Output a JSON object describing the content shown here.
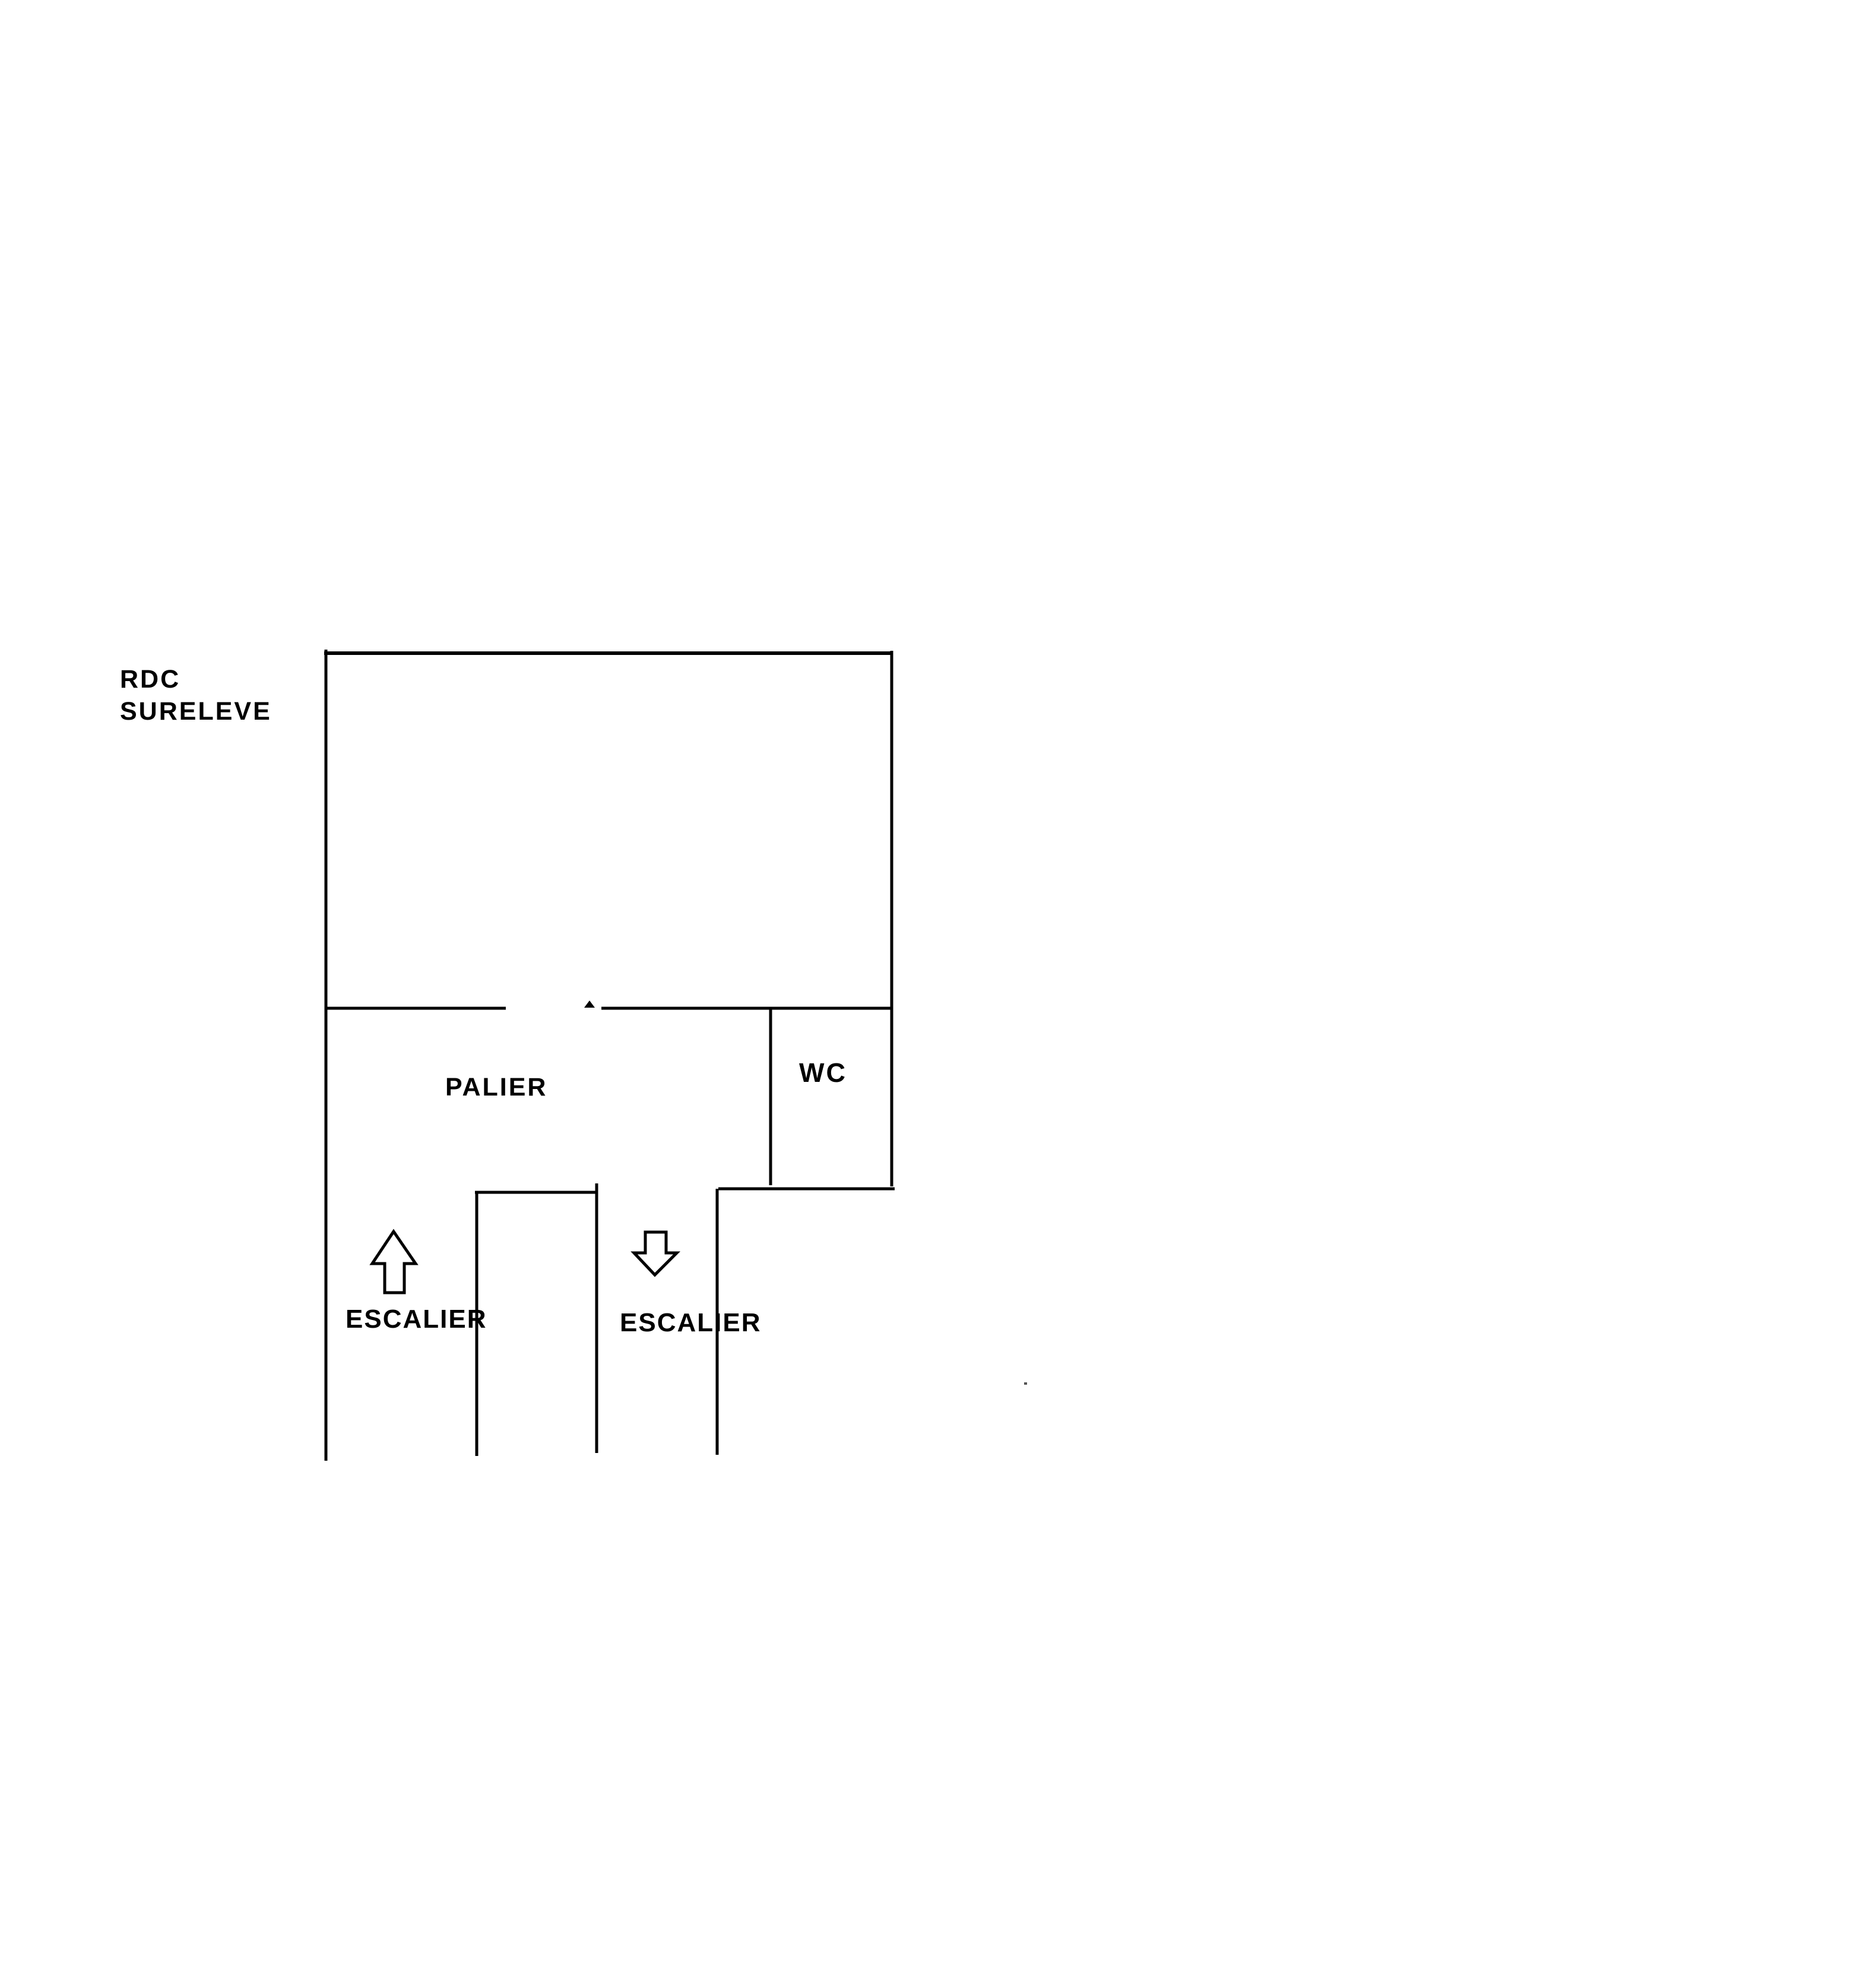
{
  "page": {
    "background_color": "#ffffff",
    "ink_color": "#000000"
  },
  "plan": {
    "type": "hand-drawn floor plan sketch",
    "floor_label": {
      "line1": "RDC",
      "line2": "SURELEVE"
    },
    "rooms": [
      {
        "name": "landing",
        "label": "PALIER"
      },
      {
        "name": "toilet",
        "label": "WC"
      }
    ],
    "stairs": [
      {
        "name": "stair-up",
        "label": "ESCALIER",
        "direction": "up",
        "icon": "arrow-up-icon"
      },
      {
        "name": "stair-down",
        "label": "ESCALIER",
        "direction": "down",
        "icon": "arrow-down-icon"
      }
    ]
  }
}
